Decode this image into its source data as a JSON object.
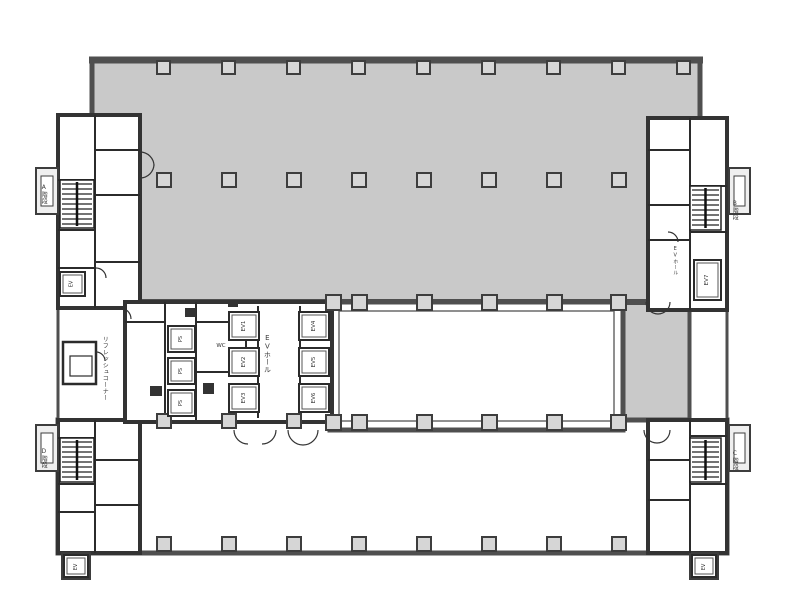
{
  "floor_plan": {
    "colors": {
      "tenant_fill": "#c9c9c9",
      "wall": "#4f4f4f",
      "partition": "#2b2b2b",
      "pillar_fill": "#d6d6d6"
    },
    "labels": {
      "stair_a": "A階段",
      "stair_b": "B階段",
      "stair_c": "C階段",
      "stair_d": "D階段",
      "ev_hall_center": "EVホール",
      "ev_hall_right": "EVホール",
      "ev_units": [
        "EV1",
        "EV2",
        "EV3",
        "EV4",
        "EV5",
        "EV6"
      ],
      "ev7": "EV7",
      "service_shafts": [
        "PS",
        "PS",
        "PS"
      ],
      "corner_ev": "EV",
      "wc": "WC",
      "refresh_corner": "リフレッシュコーナー"
    }
  }
}
